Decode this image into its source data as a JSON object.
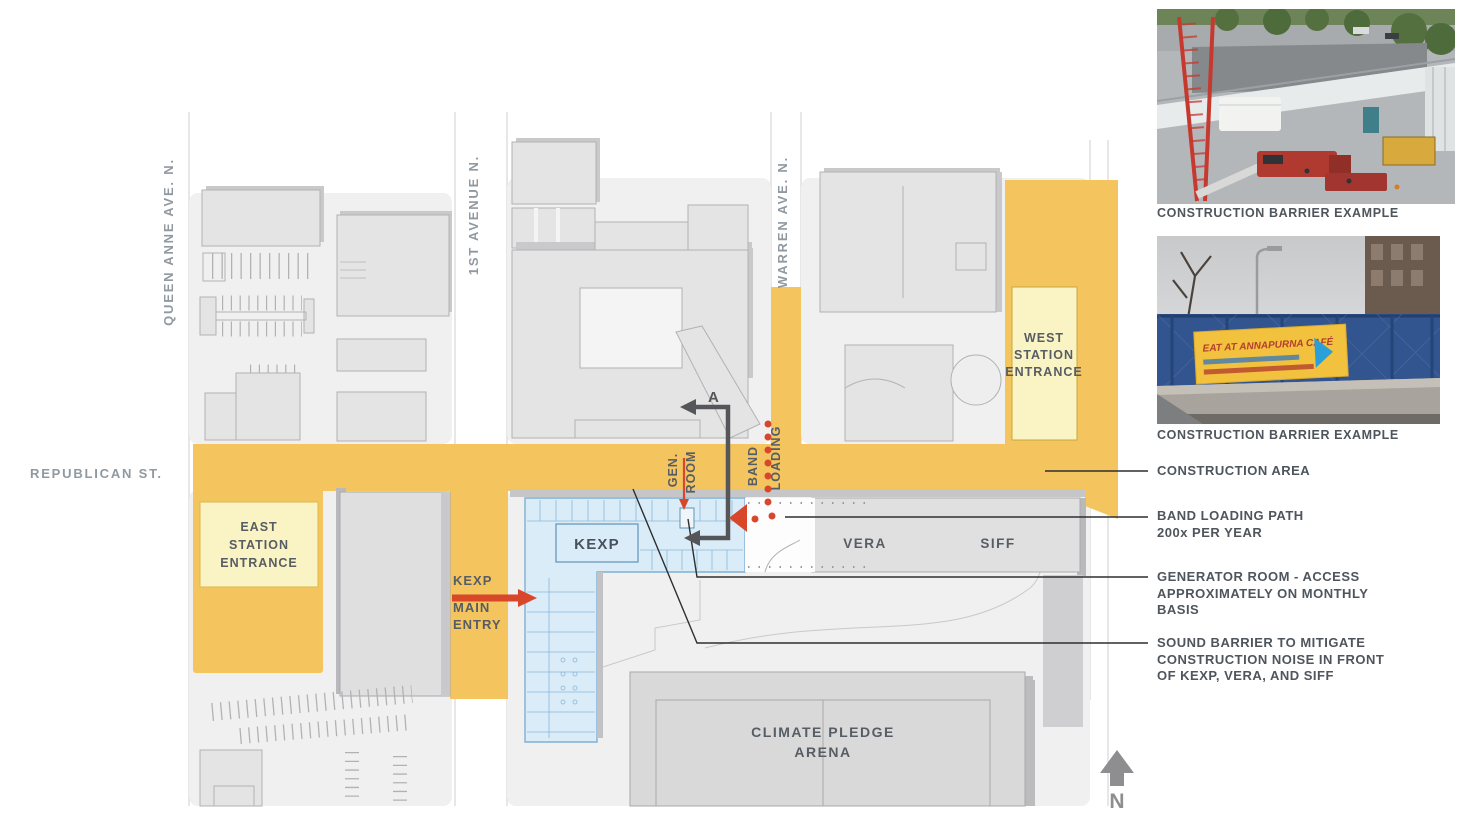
{
  "map": {
    "streets": {
      "queen_anne": "QUEEN ANNE AVE. N.",
      "first_avenue": "1ST AVENUE N.",
      "warren": "WARREN AVE. N.",
      "republican": "REPUBLICAN ST."
    },
    "stations": {
      "east": [
        "EAST",
        "STATION",
        "ENTRANCE"
      ],
      "west": [
        "WEST",
        "STATION",
        "ENTRANCE"
      ]
    },
    "buildings": {
      "kexp": "KEXP",
      "vera": "VERA",
      "siff": "SIFF",
      "arena": [
        "CLIMATE PLEDGE",
        "ARENA"
      ]
    },
    "annotations": {
      "kexp_entry": [
        "KEXP",
        "MAIN",
        "ENTRY"
      ],
      "gen_room": [
        "GEN.",
        "ROOM"
      ],
      "band_loading": [
        "BAND",
        "LOADING"
      ],
      "route_label": "A",
      "north_label": "N"
    }
  },
  "legend": {
    "items": [
      {
        "lines": [
          "CONSTRUCTION AREA",
          "",
          ""
        ]
      },
      {
        "lines": [
          "BAND LOADING PATH",
          "200x PER YEAR",
          ""
        ]
      },
      {
        "lines": [
          "GENERATOR ROOM - ACCESS",
          "APPROXIMATELY ON MONTHLY",
          "BASIS"
        ]
      },
      {
        "lines": [
          "SOUND BARRIER TO MITIGATE",
          "CONSTRUCTION NOISE IN FRONT",
          "OF KEXP, VERA, AND SIFF"
        ]
      }
    ]
  },
  "photos": [
    {
      "caption": "CONSTRUCTION BARRIER EXAMPLE"
    },
    {
      "caption": "CONSTRUCTION BARRIER EXAMPLE",
      "banner_text": "EAT AT ANNAPURNA CAFÉ"
    }
  ],
  "colors": {
    "construction_yellow": "#F4C45F",
    "station_yellow": "#FAF3C3",
    "kexp_blue": "#D9ECF8",
    "accent_red": "#D9472B",
    "route_path_gray": "#55565A",
    "block_gray": "#F0F0F1",
    "building_gray": "#E4E4E5"
  }
}
